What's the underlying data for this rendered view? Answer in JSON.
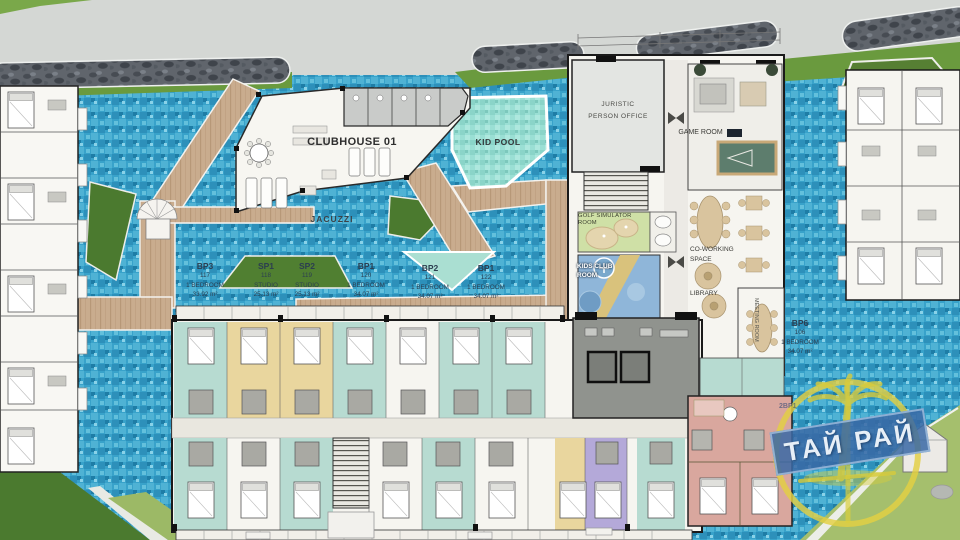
{
  "site": {
    "clubhouse": "CLUBHOUSE 01",
    "kid_pool": "KID POOL",
    "jacuzzi": "JACUZZI"
  },
  "rooms": {
    "juristic_line1": "JURISTIC",
    "juristic_line2": "PERSON OFFICE",
    "game_room": "GAME ROOM",
    "golf_simulator": "GOLF SIMULATOR ROOM",
    "kids_club_line1": "KIDS CLUB",
    "kids_club_line2": "ROOM",
    "co_working_line1": "CO-WORKING",
    "co_working_line2": "SPACE",
    "library": "LIBRARY",
    "meeting_room": "MEETING ROOM"
  },
  "units": [
    {
      "code": "BP3",
      "number": "117",
      "type": "1 BEDROOM",
      "area": "33.92 m²"
    },
    {
      "code": "SP1",
      "number": "118",
      "type": "STUDIO",
      "area": "25.13 m²"
    },
    {
      "code": "SP2",
      "number": "119",
      "type": "STUDIO",
      "area": "25.13 m²"
    },
    {
      "code": "BP1",
      "number": "120",
      "type": "1 BEDROOM",
      "area": "34.07 m²"
    },
    {
      "code": "BP2",
      "number": "121",
      "type": "1 BEDROOM",
      "area": "34.07 m²"
    },
    {
      "code": "BP1",
      "number": "122",
      "type": "1 BEDROOM",
      "area": "34.07 m²"
    },
    {
      "code": "BP6",
      "number": "106",
      "type": "1 BEDROOM",
      "area": "34.07 m²"
    }
  ],
  "overlay": {
    "partial_unit_label": "2BP1"
  },
  "watermark": {
    "text": "ТАЙ РАЙ"
  },
  "colors": {
    "pool": "#38a2ca",
    "kid_pool": "#9adfd4",
    "deck": "#c9ac8e",
    "grass_band": "#6a9a3e",
    "grass_island": "#4b7a2f",
    "lawn": "#a5bf6d",
    "unit_teal": "#b7dbd1",
    "unit_yellow": "#e9d69e",
    "unit_purple": "#b4a9d9",
    "unit_pink": "#d9a79e",
    "core_gray": "#90938e",
    "watermark_yellow": "#e3d042",
    "banner_blue": "#3a68a4"
  }
}
